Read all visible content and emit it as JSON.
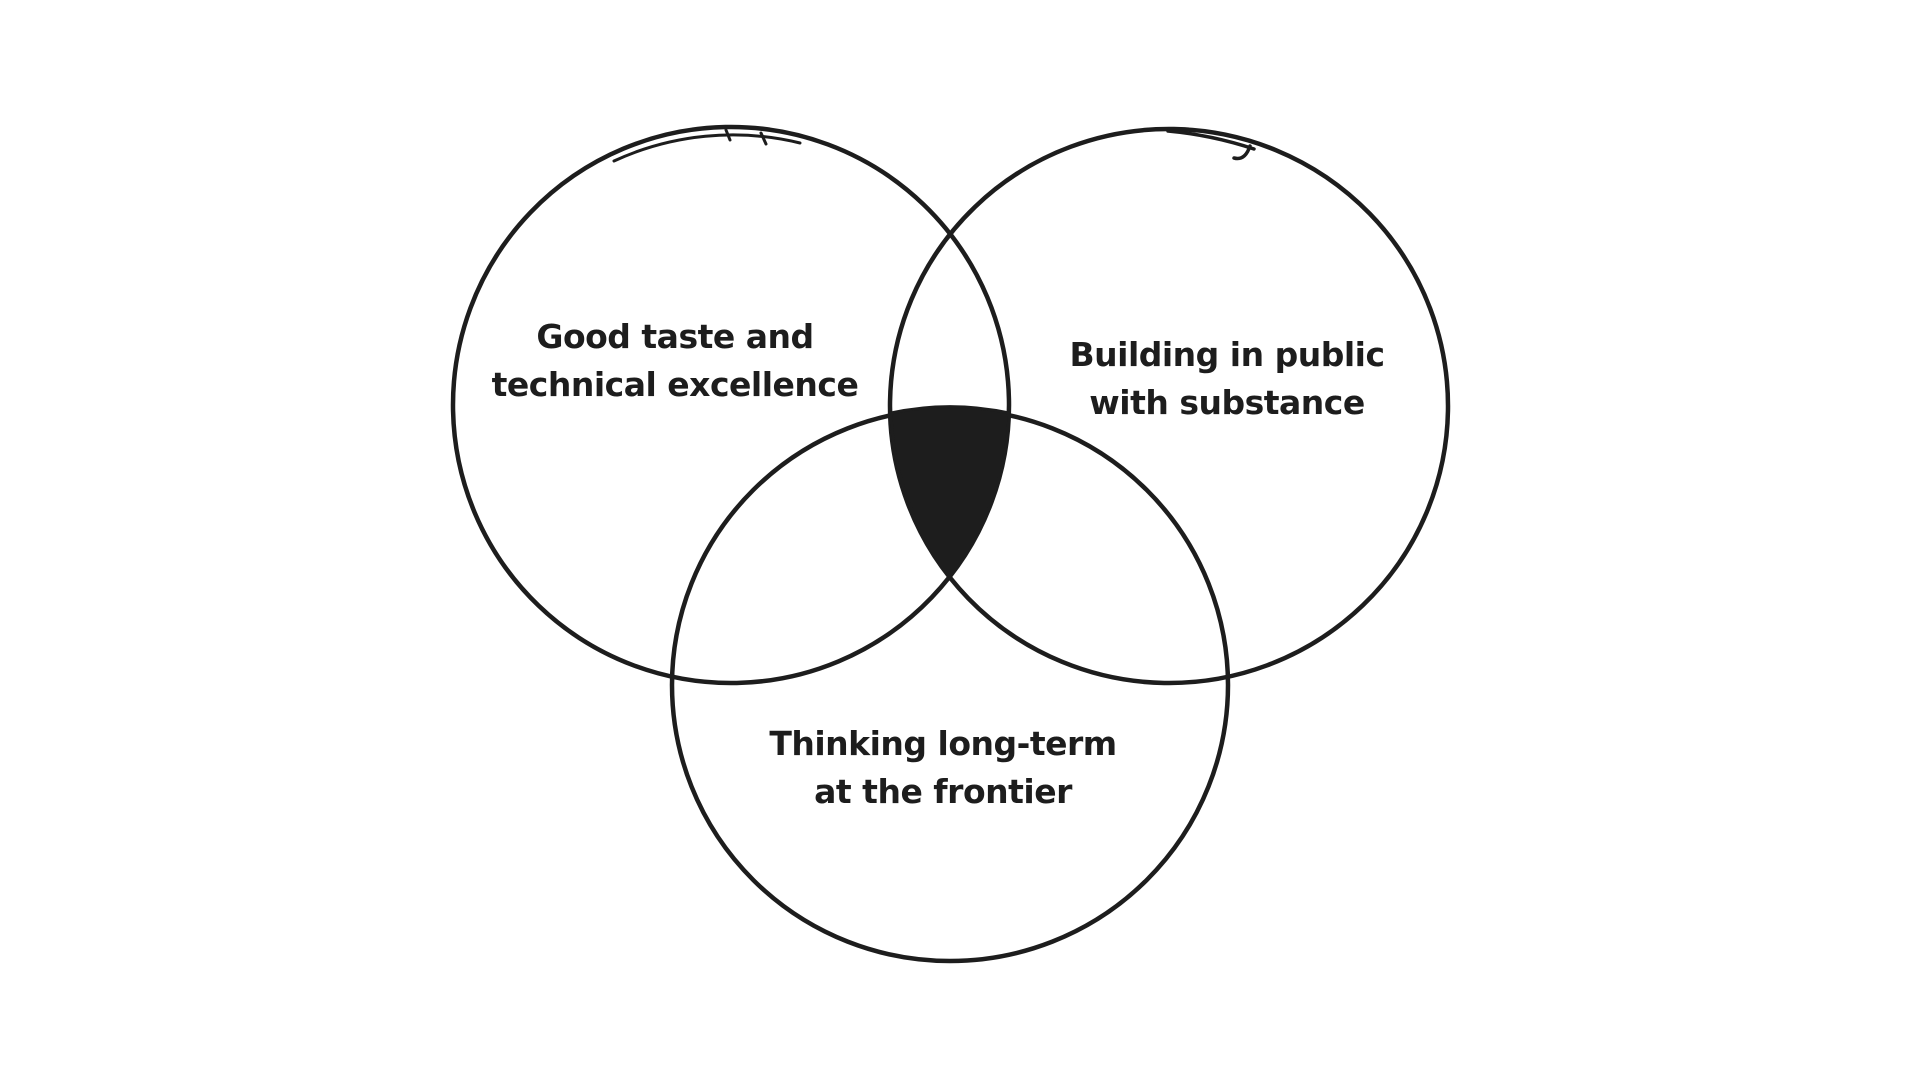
{
  "diagram": {
    "type": "venn",
    "style": "hand-drawn sketch",
    "background_color": "#ffffff",
    "ink_color": "#1d1d1d",
    "intersection_fill_color": "#1d1d1d",
    "center_overlap_filled": true,
    "circles": [
      {
        "id": "good-taste",
        "position": "top-left",
        "label": [
          "Good taste and",
          "technical excellence"
        ]
      },
      {
        "id": "building-public",
        "position": "top-right",
        "label": [
          "Building in public",
          "with substance"
        ]
      },
      {
        "id": "long-term",
        "position": "bottom",
        "label": [
          "Thinking long-term",
          "at the frontier"
        ]
      }
    ]
  }
}
